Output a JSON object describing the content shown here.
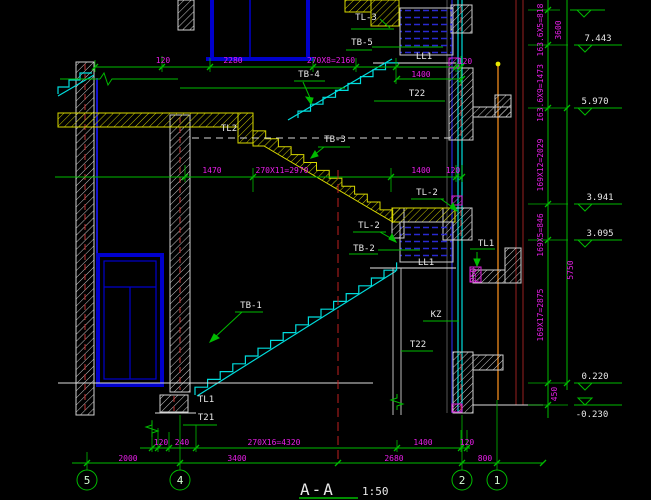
{
  "drawing": {
    "title": "A-A",
    "scale_label": "1:50",
    "type": "building stair section (CAD)",
    "colors": {
      "background": "#000000",
      "dimension_text": "#e81ee8",
      "dimension_lines": "#00bb00",
      "structure_lines": "#e8e8e8",
      "stair_lines": "#00dddd",
      "slab_hatch": "#c8c800",
      "window_frame": "#0000cd"
    }
  },
  "component_labels": [
    {
      "t": "TL-3",
      "x": 366,
      "y": 20
    },
    {
      "t": "TB-5",
      "x": 362,
      "y": 45
    },
    {
      "t": "LL1",
      "x": 424,
      "y": 59
    },
    {
      "t": "T22",
      "x": 417,
      "y": 96
    },
    {
      "t": "TB-4",
      "x": 309,
      "y": 77
    },
    {
      "t": "TL2",
      "x": 229,
      "y": 131
    },
    {
      "t": "TB-3",
      "x": 335,
      "y": 142
    },
    {
      "t": "TL-2",
      "x": 427,
      "y": 195
    },
    {
      "t": "TL-2",
      "x": 369,
      "y": 228
    },
    {
      "t": "TB-2",
      "x": 364,
      "y": 251
    },
    {
      "t": "LL1",
      "x": 426,
      "y": 265
    },
    {
      "t": "TL1",
      "x": 486,
      "y": 246
    },
    {
      "t": "KZ",
      "x": 436,
      "y": 317
    },
    {
      "t": "T22",
      "x": 418,
      "y": 347
    },
    {
      "t": "TB-1",
      "x": 251,
      "y": 308
    },
    {
      "t": "TL1",
      "x": 206,
      "y": 402
    },
    {
      "t": "T21",
      "x": 206,
      "y": 420
    }
  ],
  "dimensions": [
    {
      "t": "120",
      "x": 163,
      "y": 63
    },
    {
      "t": "2280",
      "x": 233,
      "y": 63
    },
    {
      "t": "270X8=2160",
      "x": 331,
      "y": 63
    },
    {
      "t": "1400",
      "x": 421,
      "y": 77
    },
    {
      "t": "120",
      "x": 465,
      "y": 64
    },
    {
      "t": "1470",
      "x": 212,
      "y": 173
    },
    {
      "t": "270X11=2970",
      "x": 282,
      "y": 173
    },
    {
      "t": "1400",
      "x": 421,
      "y": 173
    },
    {
      "t": "120",
      "x": 453,
      "y": 173
    },
    {
      "t": "120",
      "x": 161,
      "y": 445
    },
    {
      "t": "240",
      "x": 182,
      "y": 445
    },
    {
      "t": "270X16=4320",
      "x": 274,
      "y": 445
    },
    {
      "t": "1400",
      "x": 423,
      "y": 445
    },
    {
      "t": "120",
      "x": 467,
      "y": 445
    },
    {
      "t": "2000",
      "x": 128,
      "y": 461
    },
    {
      "t": "3400",
      "x": 237,
      "y": 461
    },
    {
      "t": "2680",
      "x": 394,
      "y": 461
    },
    {
      "t": "800",
      "x": 485,
      "y": 461
    },
    {
      "t": "250",
      "x": 476,
      "y": 275,
      "r": -90
    },
    {
      "t": "163.6X5=818",
      "x": 543,
      "y": 30,
      "r": -90
    },
    {
      "t": "163.6X9=1473",
      "x": 543,
      "y": 93,
      "r": -90
    },
    {
      "t": "169X12=2029",
      "x": 543,
      "y": 165,
      "r": -90
    },
    {
      "t": "169X5=846",
      "x": 543,
      "y": 235,
      "r": -90
    },
    {
      "t": "169X17=2875",
      "x": 543,
      "y": 315,
      "r": -90
    },
    {
      "t": "450",
      "x": 557,
      "y": 394,
      "r": -90
    },
    {
      "t": "3600",
      "x": 561,
      "y": 30,
      "r": -90
    },
    {
      "t": "5750",
      "x": 573,
      "y": 270,
      "r": -90
    }
  ],
  "elevations": [
    {
      "t": "7.443",
      "x": 598,
      "y": 41
    },
    {
      "t": "5.970",
      "x": 595,
      "y": 104
    },
    {
      "t": "3.941",
      "x": 600,
      "y": 200
    },
    {
      "t": "3.095",
      "x": 600,
      "y": 236
    },
    {
      "t": "0.220",
      "x": 595,
      "y": 379
    },
    {
      "t": "-0.230",
      "x": 592,
      "y": 417
    }
  ],
  "grid_bubbles": {
    "y": 480,
    "r": 10,
    "items": [
      {
        "label": "5",
        "x": 87
      },
      {
        "label": "4",
        "x": 180
      },
      {
        "label": "2",
        "x": 462
      },
      {
        "label": "1",
        "x": 497
      }
    ]
  }
}
